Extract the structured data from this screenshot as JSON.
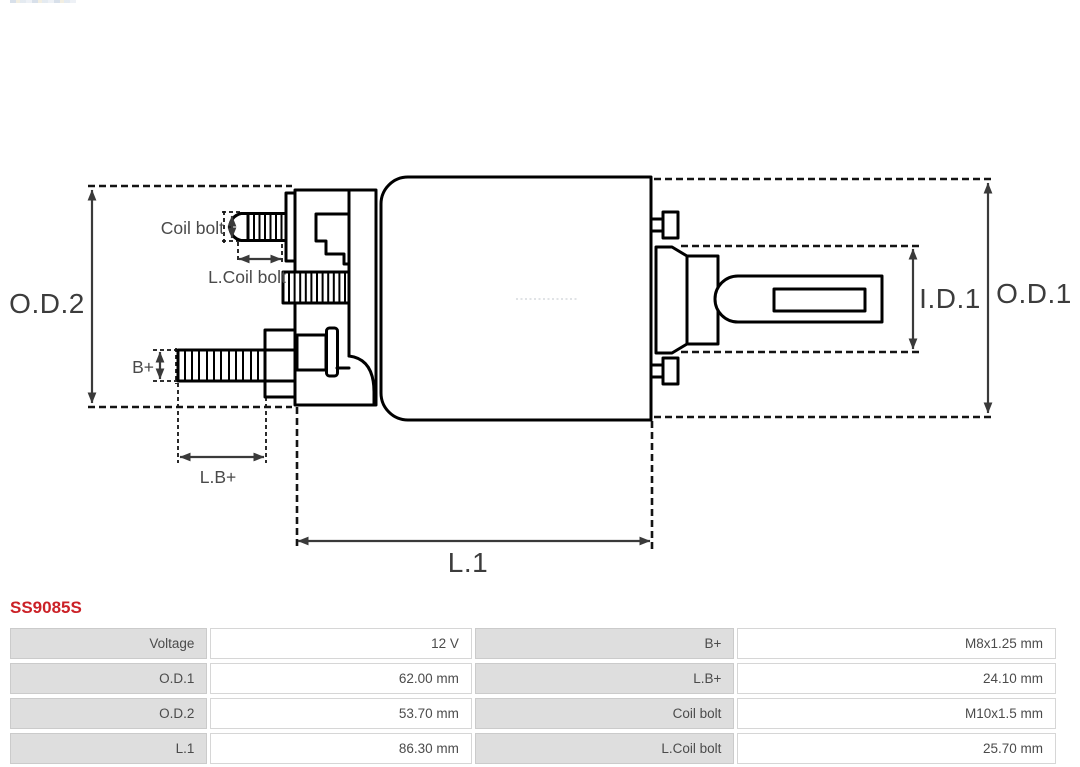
{
  "colors": {
    "part_number_red": "#cb2127",
    "outline_black": "#000000",
    "dimension_gray": "#3a3a3a",
    "table_label_bg": "#dedede",
    "table_border": "#d6d6d6",
    "table_text": "#4b4b4b"
  },
  "diagram": {
    "labels": {
      "od2": "O.D.2",
      "od1": "O.D.1",
      "id1": "I.D.1",
      "l1": "L.1",
      "coil_bolt": "Coil bolt",
      "l_coil_bolt": "L.Coil bolt",
      "b_plus": "B+",
      "l_b_plus": "L.B+"
    }
  },
  "part_number": "SS9085S",
  "spec_table": {
    "rows": [
      {
        "label1": "Voltage",
        "value1": "12 V",
        "label2": "B+",
        "value2": "M8x1.25 mm"
      },
      {
        "label1": "O.D.1",
        "value1": "62.00 mm",
        "label2": "L.B+",
        "value2": "24.10 mm"
      },
      {
        "label1": "O.D.2",
        "value1": "53.70 mm",
        "label2": "Coil bolt",
        "value2": "M10x1.5 mm"
      },
      {
        "label1": "L.1",
        "value1": "86.30 mm",
        "label2": "L.Coil bolt",
        "value2": "25.70 mm"
      }
    ]
  }
}
